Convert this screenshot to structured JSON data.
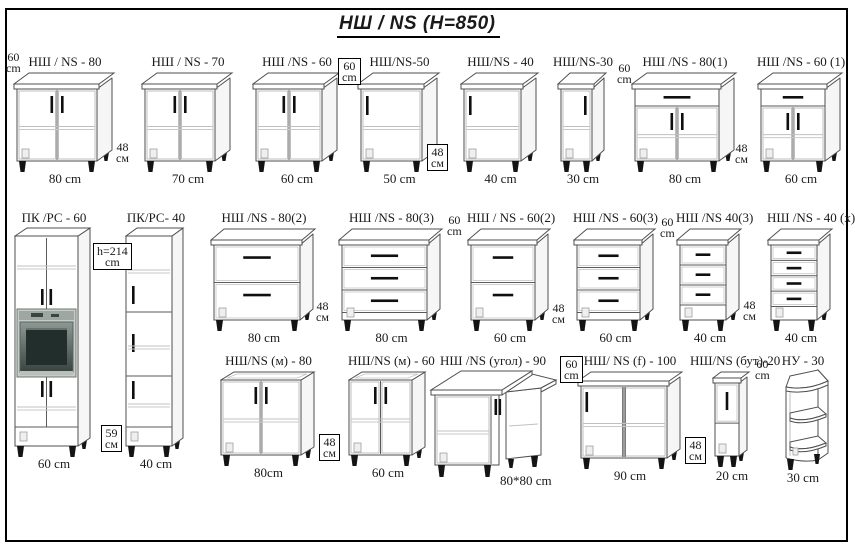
{
  "title": "НШ / NS  (H=850)",
  "cabinets": [
    {
      "name": "НШ / NS - 80",
      "width_label": "80 cm",
      "type": "base",
      "doors": 2
    },
    {
      "name": "НШ / NS - 70",
      "width_label": "70 cm",
      "type": "base",
      "doors": 2
    },
    {
      "name": "НШ /NS - 60",
      "width_label": "60 cm",
      "type": "base",
      "doors": 2
    },
    {
      "name": "НШ/NS-50",
      "width_label": "50 cm",
      "type": "base",
      "doors": 1,
      "handle_pos": "left"
    },
    {
      "name": "НШ/NS - 40",
      "width_label": "40 cm",
      "type": "base",
      "doors": 1,
      "handle_pos": "left"
    },
    {
      "name": "НШ/NS-30",
      "width_label": "30 cm",
      "type": "base",
      "doors": 1,
      "handle_pos": "right"
    },
    {
      "name": "НШ /NS - 80(1)",
      "width_label": "80 cm",
      "type": "base",
      "doors": 2,
      "top_drawer": true
    },
    {
      "name": "НШ /NS - 60 (1)",
      "width_label": "60 cm",
      "type": "base",
      "doors": 2,
      "top_drawer": true
    },
    {
      "name": "ПК /РС - 60",
      "width_label": "60 cm",
      "type": "tall_oven"
    },
    {
      "name": "ПК/РС- 40",
      "width_label": "40 cm",
      "type": "tall_doors3"
    },
    {
      "name": "НШ /NS - 80(2)",
      "width_label": "80 cm",
      "type": "drawers",
      "drawers": 2
    },
    {
      "name": "НШ /NS - 80(3)",
      "width_label": "80 cm",
      "type": "drawers",
      "drawers": 3
    },
    {
      "name": "НШ / NS - 60(2)",
      "width_label": "60 cm",
      "type": "drawers",
      "drawers": 2
    },
    {
      "name": "НШ /NS - 60(3)",
      "width_label": "60 cm",
      "type": "drawers",
      "drawers": 3
    },
    {
      "name": "НШ /NS 40(3)",
      "width_label": "40 cm",
      "type": "drawers",
      "drawers": 3
    },
    {
      "name": "НШ /NS - 40 (х)",
      "width_label": "40 cm",
      "type": "drawers",
      "drawers": 4
    },
    {
      "name": "НШ/NS (м) - 80",
      "width_label": "80cm",
      "type": "sink",
      "doors": 2
    },
    {
      "name": "НШ/NS (м) - 60",
      "width_label": "60 cm",
      "type": "sink",
      "doors": 2
    },
    {
      "name": "НШ /NS (угол) - 90",
      "width_label": "80*80 cm",
      "type": "corner"
    },
    {
      "name": "НШ/ NS (f) - 100",
      "width_label": "90 cm",
      "type": "base",
      "doors": 2,
      "handle_pos": "left"
    },
    {
      "name": "НШ/NS (бут)-20",
      "width_label": "20 cm",
      "type": "bottle",
      "doors": 1
    },
    {
      "name": "НУ - 30",
      "width_label": "30 cm",
      "type": "open_shelf"
    }
  ],
  "annotations": [
    {
      "line1": "60",
      "line2": "cm",
      "boxed": false
    },
    {
      "line1": "48",
      "line2": "см",
      "boxed": false
    },
    {
      "line1": "60",
      "line2": "cm",
      "boxed": true
    },
    {
      "line1": "48",
      "line2": "см",
      "boxed": true
    },
    {
      "line1": "60",
      "line2": "cm",
      "boxed": false
    },
    {
      "line1": "48",
      "line2": "см",
      "boxed": false
    },
    {
      "line1": "h=214",
      "line2": "cm",
      "boxed": true
    },
    {
      "line1": "59",
      "line2": "см",
      "boxed": true
    },
    {
      "line1": "48",
      "line2": "см",
      "boxed": false
    },
    {
      "line1": "60",
      "line2": "cm",
      "boxed": false
    },
    {
      "line1": "48",
      "line2": "см",
      "boxed": false
    },
    {
      "line1": "60",
      "line2": "cm",
      "boxed": false
    },
    {
      "line1": "48",
      "line2": "см",
      "boxed": false
    },
    {
      "line1": "48",
      "line2": "см",
      "boxed": true
    },
    {
      "line1": "60",
      "line2": "cm",
      "boxed": true
    },
    {
      "line1": "48",
      "line2": "см",
      "boxed": true
    },
    {
      "line1": "60",
      "line2": "cm",
      "boxed": false
    }
  ]
}
